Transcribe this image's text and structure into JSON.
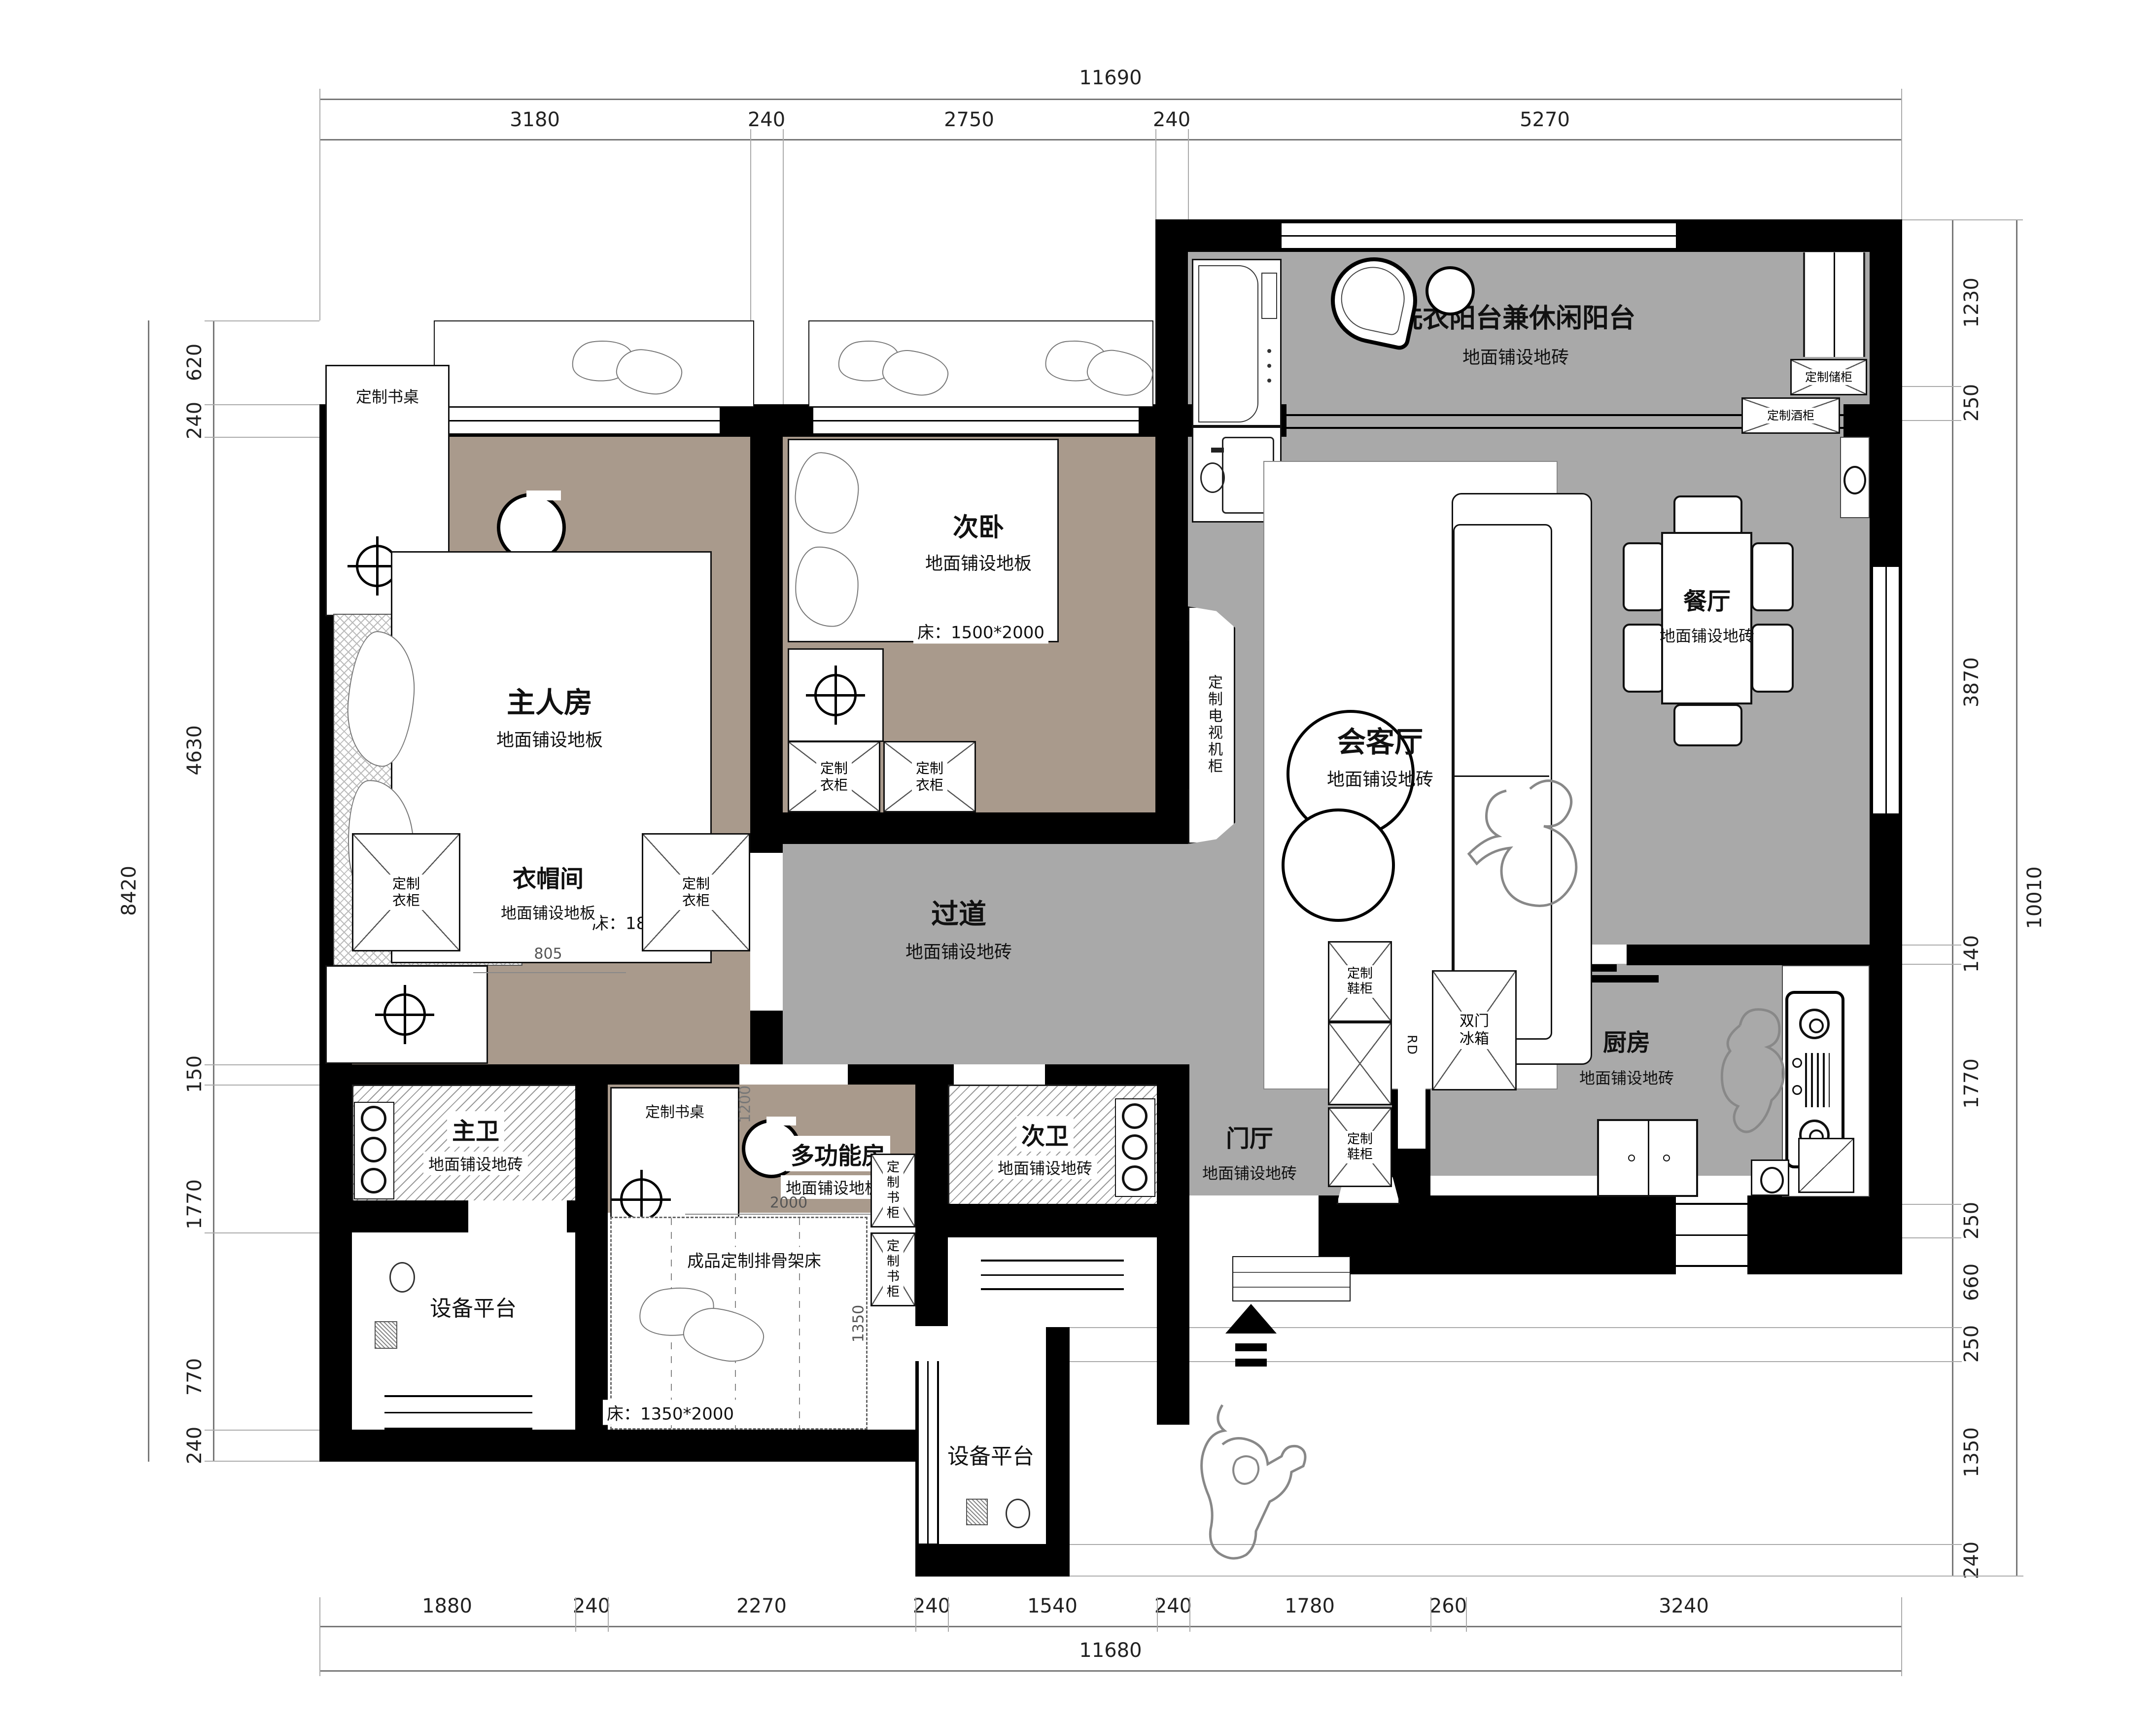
{
  "colors": {
    "wall": "#000000",
    "wood_floor": "#a99a8c",
    "tile_floor": "#a9a9a9",
    "hatch_line": "#999999",
    "paper": "#ffffff"
  },
  "dims": {
    "top": {
      "total": "11690",
      "segments": [
        "3180",
        "240",
        "2750",
        "240",
        "5270"
      ]
    },
    "bottom": {
      "total": "11680",
      "segments": [
        "1880",
        "240",
        "2270",
        "240",
        "1540",
        "240",
        "1780",
        "260",
        "3240"
      ]
    },
    "left": {
      "total": "8420",
      "segments": [
        "620",
        "240",
        "4630",
        "150",
        "1770",
        "770",
        "240"
      ]
    },
    "right": {
      "total": "10010",
      "segments": [
        "1230",
        "250",
        "3870",
        "140",
        "1770",
        "250",
        "660",
        "250",
        "1350",
        "240"
      ]
    }
  },
  "rooms": {
    "master": {
      "name": "主人房",
      "floor": "地面铺设地板",
      "bed": "床：1800*2100"
    },
    "second": {
      "name": "次卧",
      "floor": "地面铺设地板",
      "bed": "床：1500*2000"
    },
    "balcony": {
      "name": "洗衣阳台兼休闲阳台",
      "floor": "地面铺设地砖"
    },
    "living": {
      "name": "会客厅",
      "floor": "地面铺设地砖"
    },
    "dining": {
      "name": "餐厅",
      "floor": "地面铺设地砖"
    },
    "corridor": {
      "name": "过道",
      "floor": "地面铺设地砖"
    },
    "cloakroom": {
      "name": "衣帽间",
      "floor": "地面铺设地板",
      "opening_dim": "805"
    },
    "master_bath": {
      "name": "主卫",
      "floor": "地面铺设地砖"
    },
    "multi": {
      "name": "多功能房",
      "floor": "地面铺设地板",
      "bed_name": "成品定制排骨架床",
      "bed": "床：1350*2000",
      "dim_width": "2000",
      "dim_depth": "1350",
      "dim_door": "1200"
    },
    "second_bath": {
      "name": "次卫",
      "floor": "地面铺设地砖"
    },
    "kitchen": {
      "name": "厨房",
      "floor": "地面铺设地砖",
      "fridge": "双门冰箱",
      "rd": "RD"
    },
    "entry": {
      "name": "门厅",
      "floor": "地面铺设地砖"
    },
    "platform_left": {
      "name": "设备平台"
    },
    "platform_bottom": {
      "name": "设备平台"
    }
  },
  "cabinets": {
    "desk_master": "定制书桌",
    "desk_multi": "定制书桌",
    "wardrobe_a": "定制衣柜",
    "wardrobe_b": "定制衣柜",
    "wardrobe_c": "定制衣柜",
    "wardrobe_d": "定制衣柜",
    "tv_cabinet": "定制电视机柜",
    "storage": "定制储柜",
    "wine": "定制酒柜",
    "book_a": "定制书柜",
    "book_b": "定制书柜",
    "shoe_a": "定制鞋柜",
    "shoe_b": "定制鞋柜"
  }
}
